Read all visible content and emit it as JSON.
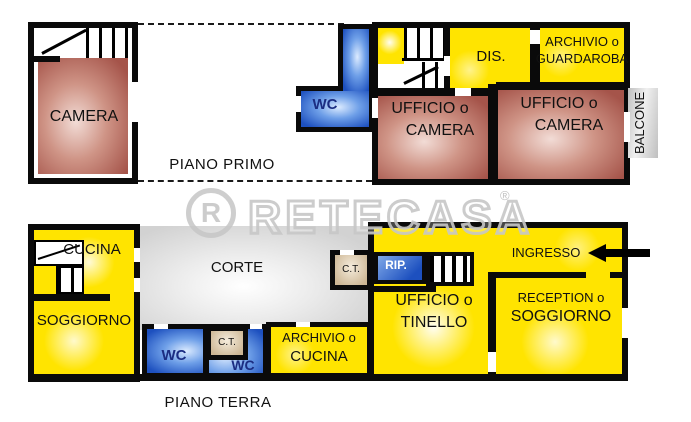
{
  "plan": {
    "watermark": {
      "logo_letter": "R",
      "brand": "RETECASA",
      "registered": "®"
    },
    "upper_floor": {
      "label": "PIANO PRIMO",
      "camera": "CAMERA",
      "wc": "WC",
      "dis": "DIS.",
      "archivio_guardaroba": {
        "line1": "ARCHIVIO o",
        "line2": "GUARDAROBA"
      },
      "ufficio_camera_left": {
        "line1": "UFFICIO o",
        "line2": "CAMERA"
      },
      "ufficio_camera_right": {
        "line1": "UFFICIO o",
        "line2": "CAMERA"
      },
      "balcone": "BALCONE"
    },
    "ground_floor": {
      "label": "PIANO TERRA",
      "cucina": "CUCINA",
      "soggiorno": "SOGGIORNO",
      "corte": "CORTE",
      "ct_upper": "C.T.",
      "rip": "RIP.",
      "ingresso": "INGRESSO",
      "ufficio_tinello": {
        "line1": "UFFICIO o",
        "line2": "TINELLO"
      },
      "reception_soggiorno": {
        "line1": "RECEPTION o",
        "line2": "SOGGIORNO"
      },
      "wc_left": "WC",
      "ct_lower": "C.T.",
      "wc_right": "WC",
      "archivio_cucina": {
        "line1": "ARCHIVIO o",
        "line2": "CUCINA"
      }
    },
    "colors": {
      "room_red": "#a5544a",
      "room_yellow": "#ffe400",
      "room_blue": "#1d50bf",
      "court_gray": "#d2d2d2",
      "ct_tan": "#d8c5a4",
      "balcony_gray": "#cccccc",
      "wall_black": "#0a0a0a",
      "watermark_gray": "#c6c6c6"
    }
  }
}
